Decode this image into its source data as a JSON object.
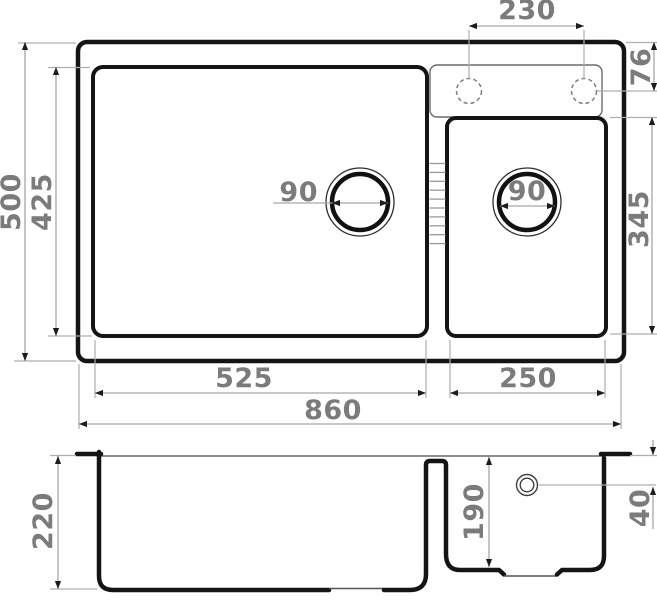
{
  "drawing": {
    "type": "kitchen-sink technical drawing, top view and cross-section, two bowls",
    "units": "mm"
  },
  "dims": {
    "faucet_hole_spacing": "230",
    "faucet_hole_offset": "76",
    "overall_depth": "500",
    "main_bowl_depth": "425",
    "main_drain_diameter": "90",
    "small_drain_diameter": "90",
    "small_bowl_depth": "345",
    "main_bowl_width": "525",
    "small_bowl_width": "250",
    "overall_width": "860",
    "bowl_outer_height": "220",
    "small_bowl_inner_depth": "190",
    "overflow_offset": "40"
  }
}
